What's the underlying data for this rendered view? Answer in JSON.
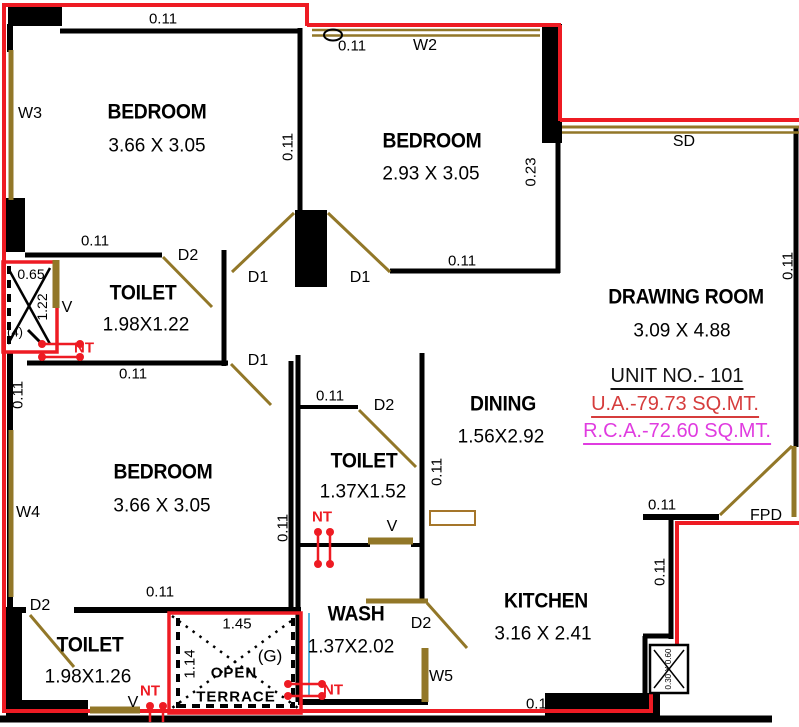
{
  "plan": {
    "unit_info": {
      "unit_no": "UNIT NO.- 101",
      "ua": "U.A.-79.73 SQ.MT.",
      "rca": "R.C.A.-72.60 SQ.MT."
    },
    "rooms": {
      "bedroom1": {
        "name": "BEDROOM",
        "dims": "3.66 X 3.05"
      },
      "bedroom2": {
        "name": "BEDROOM",
        "dims": "2.93 X 3.05"
      },
      "bedroom3": {
        "name": "BEDROOM",
        "dims": "3.66 X 3.05"
      },
      "drawing_room": {
        "name": "DRAWING ROOM",
        "dims": "3.09 X 4.88"
      },
      "dining": {
        "name": "DINING",
        "dims": "1.56X2.92"
      },
      "kitchen": {
        "name": "KITCHEN",
        "dims": "3.16 X 2.41"
      },
      "toilet1": {
        "name": "TOILET",
        "dims": "1.98X1.22"
      },
      "toilet2": {
        "name": "TOILET",
        "dims": "1.37X1.52"
      },
      "toilet3": {
        "name": "TOILET",
        "dims": "1.98X1.26"
      },
      "wash": {
        "name": "WASH",
        "dims": "1.37X2.02"
      },
      "open_terrace": {
        "line1": "OPEN",
        "line2": "TERRACE",
        "dim_w": "1.45",
        "dim_h": "1.14",
        "tag": "(G)"
      }
    },
    "openings": {
      "w2": "W2",
      "w3": "W3",
      "w4": "W4",
      "w5": "W5",
      "d1": "D1",
      "d2": "D2",
      "sd": "SD",
      "fpd": "FPD",
      "v": "V",
      "nt": "NT"
    },
    "dims": {
      "wall": "0.11",
      "col": "0.23",
      "duct_w": "0.65",
      "duct_h": "1.22",
      "duct_tag": "(4)",
      "kitchen_duct": "0.30 X 0.60"
    },
    "colors": {
      "boundary": "#ee1b23",
      "wall": "#000000",
      "wood": "#927728",
      "shelf": "#a5762a",
      "ua_text": "#d63c3c",
      "rca_text": "#e03ce0",
      "plumb_blue": "#58b6dd"
    }
  }
}
